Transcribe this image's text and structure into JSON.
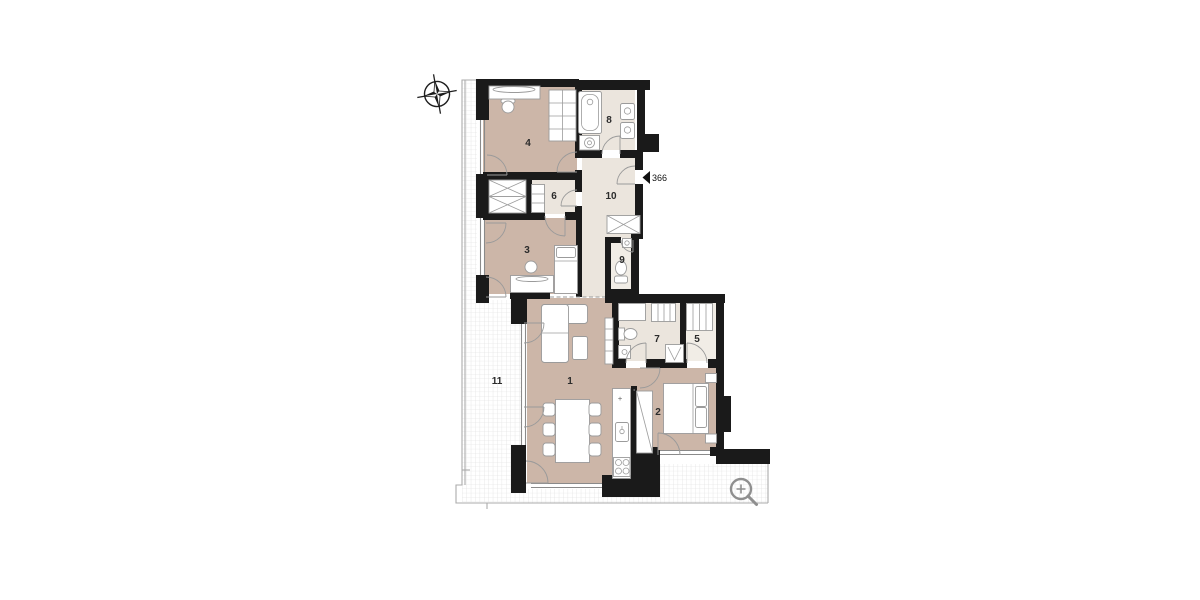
{
  "plan": {
    "rooms": [
      {
        "number": "1"
      },
      {
        "number": "2"
      },
      {
        "number": "3"
      },
      {
        "number": "4"
      },
      {
        "number": "5"
      },
      {
        "number": "6"
      },
      {
        "number": "7"
      },
      {
        "number": "8"
      },
      {
        "number": "9"
      },
      {
        "number": "10"
      },
      {
        "number": "11"
      }
    ],
    "entry_marker": {
      "label": "366"
    },
    "kitchen": {
      "fixture_mark": "+"
    },
    "icons": {
      "compass": "north-compass-icon",
      "magnifier": "zoom-in-icon",
      "entry": "entry-door-marker"
    },
    "colors": {
      "wall": "#1a1a1a",
      "room_warm": "#ccb6a8",
      "room_light": "#ebe5dd",
      "room_pale": "#f1ede6",
      "terrace_grid_line": "#dcdcdc",
      "furniture_stroke": "#9b9b9b",
      "door_arc": "#9a9a9a",
      "label_text": "#2b2b2b",
      "icon_gray": "#8f8f8f"
    }
  }
}
